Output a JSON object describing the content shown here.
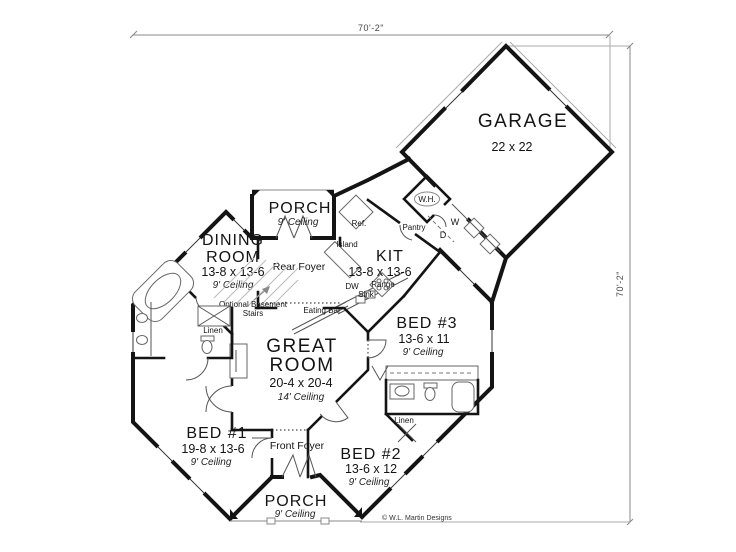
{
  "dimensions": {
    "top": "70'-2\"",
    "right": "70'-2\""
  },
  "copyright": "© W.L. Martin Designs",
  "rooms": {
    "garage": {
      "name": "GARAGE",
      "size": "22 x 22"
    },
    "porch_rear": {
      "name": "PORCH",
      "ceiling": "9' Ceiling"
    },
    "dining": {
      "name1": "DINING",
      "name2": "ROOM",
      "size": "13-8 x 13-6",
      "ceiling": "9' Ceiling"
    },
    "kitchen": {
      "name": "KIT",
      "size": "13-8 x 13-6"
    },
    "rear_foyer": {
      "name": "Rear Foyer"
    },
    "great": {
      "name1": "GREAT",
      "name2": "ROOM",
      "size": "20-4 x 20-4",
      "ceiling": "14' Ceiling"
    },
    "bed1": {
      "name": "BED #1",
      "size": "19-8 x 13-6",
      "ceiling": "9' Ceiling"
    },
    "bed2": {
      "name": "BED #2",
      "size": "13-6 x 12",
      "ceiling": "9' Ceiling"
    },
    "bed3": {
      "name": "BED #3",
      "size": "13-6 x 11",
      "ceiling": "9' Ceiling"
    },
    "front_foyer": {
      "name": "Front Foyer"
    },
    "porch_front": {
      "name": "PORCH",
      "ceiling": "9' Ceiling"
    }
  },
  "fixtures": {
    "ref": "Ref.",
    "wh": "W.H.",
    "pantry": "Pantry",
    "washer": "W",
    "dryer": "D",
    "island": "Island",
    "dw": "DW",
    "sink": "Sink",
    "range": "Range",
    "eating_bar": "Eating Bar",
    "stairs_line1": "Optional Basement",
    "stairs_line2": "Stairs",
    "linen_left": "Linen",
    "linen_right": "Linen"
  }
}
